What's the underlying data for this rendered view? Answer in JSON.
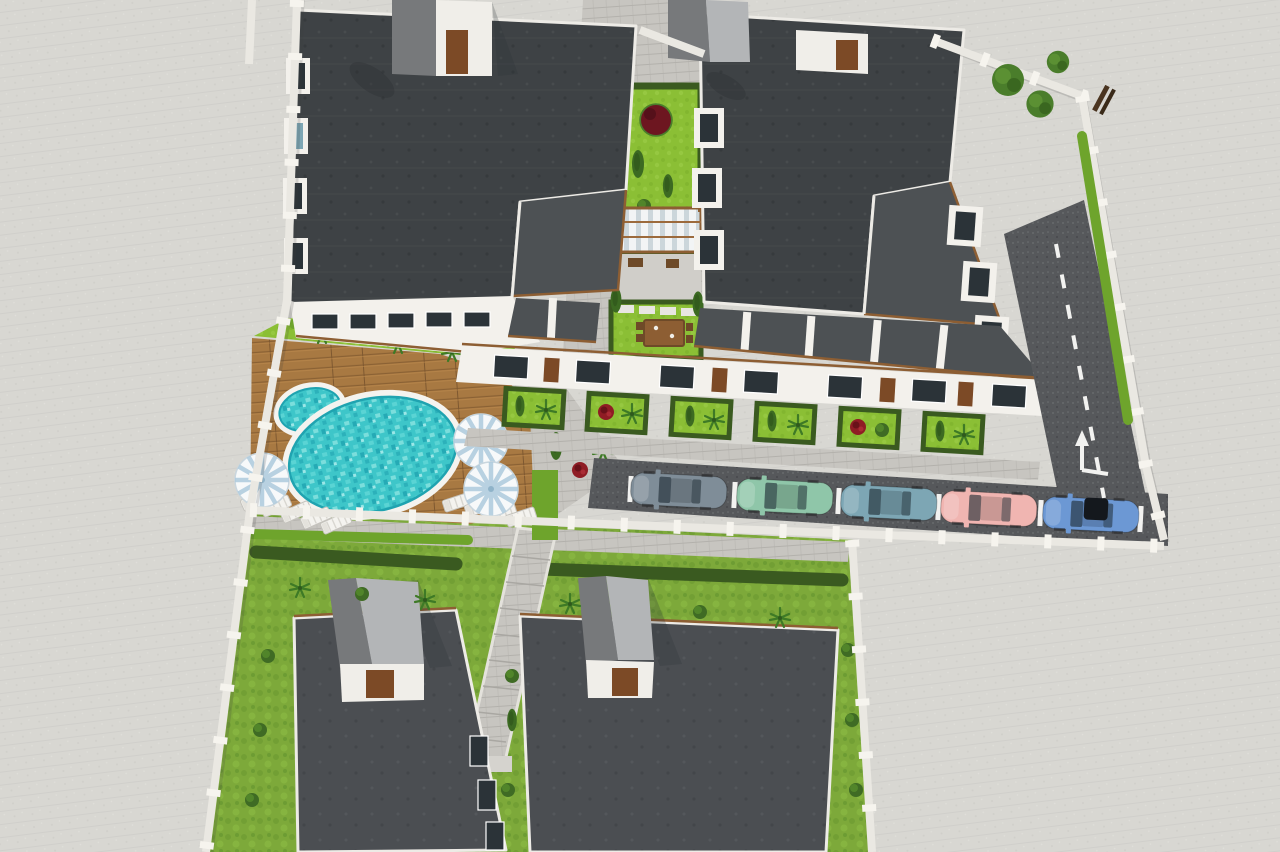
{
  "scene": {
    "title": "Aerial 3D render of a residential complex",
    "features": [
      "two upper apartment blocks",
      "central courtyard garden with pergola",
      "swimming pool terrace",
      "parking with five cars",
      "two lower blocks with lawns",
      "perimeter wall",
      "access road"
    ]
  },
  "palette": {
    "pavement": "#d8d7d2",
    "cobble": "#c7c5c0",
    "cobble_light": "#d0cec9",
    "wall": "#eae8e2",
    "roof_dark": "#3e4245",
    "roof_mid": "#4d5154",
    "roof_low": "#4b4e52",
    "parapet": "#edebe6",
    "facade": "#f3f1ec",
    "window_dark": "#2b3338",
    "door_brown": "#7c4a26",
    "wood": "#8d5e33",
    "tower_roof_dark": "#77797b",
    "tower_roof_light": "#b3b5b7",
    "grass": "#8bbf35",
    "lawn": "#7da93a",
    "hedge_dark": "#3a5a20",
    "hedge_bright": "#6ea42c",
    "tree": "#49792b",
    "tree_red": "#6d1620",
    "flower_red": "#8f1c24",
    "deck": "#a87942",
    "deck_line": "#8a6134",
    "pool_rim": "#f4f3ef",
    "water": "#3ec6c9",
    "water_light": "#82e2de",
    "water_dark": "#1fa3b0",
    "asphalt": "#56585b",
    "road": "#5e6063",
    "road_mark": "#f2f2f0",
    "parasol": "#f7f9fa",
    "parasol_stripe": "#aecbdd",
    "lounger": "#f4f3ef",
    "canopy": "#f2f4f5",
    "canopy_stripe": "#ccd6db",
    "bench": "#4a3420"
  },
  "cars": [
    {
      "name": "sedan-gray-blue",
      "color": "#7f8d98"
    },
    {
      "name": "sedan-mint-green",
      "color": "#8fc6a9"
    },
    {
      "name": "sedan-teal-blue",
      "color": "#7da6b4"
    },
    {
      "name": "sedan-pink",
      "color": "#f0b5b1"
    },
    {
      "name": "hatchback-blue",
      "color": "#6c98d4"
    }
  ],
  "counts": {
    "cars": 5,
    "parasols": 3,
    "loungers": 9,
    "buildings": 4,
    "stair_towers": 4
  }
}
